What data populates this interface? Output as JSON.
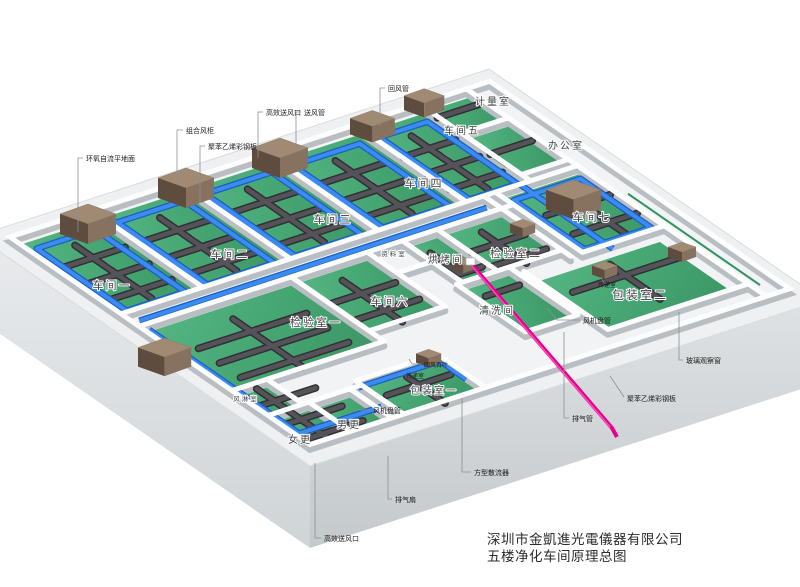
{
  "title_block": {
    "line1": "深圳市金凱進光電儀器有限公司",
    "line2": "五楼净化车间原理总图"
  },
  "colors": {
    "floor_green": "#46a673",
    "floor_green_dark": "#3c9765",
    "duct_blue": "#3b8bf2",
    "duct_blue_dark": "#1a5fc2",
    "duct_dark": "#474549",
    "ahu_brown_top": "#a18a74",
    "ahu_brown_front": "#5e4d3e",
    "exhaust_pink": "#e6008f",
    "slab_gray": "#d5d9db",
    "wall_white": "#fdfdfe",
    "stripe_green": "#2f9160"
  },
  "annotations": [
    {
      "kind": "room",
      "t": "车间一",
      "x": 112,
      "y": 289,
      "s": 11
    },
    {
      "kind": "room",
      "t": "车间二",
      "x": 230,
      "y": 258,
      "s": 11
    },
    {
      "kind": "room",
      "t": "车间三",
      "x": 333,
      "y": 223,
      "s": 11
    },
    {
      "kind": "room",
      "t": "车间四",
      "x": 424,
      "y": 187,
      "s": 11
    },
    {
      "kind": "room",
      "t": "车间五",
      "x": 462,
      "y": 134,
      "s": 10
    },
    {
      "kind": "room",
      "t": "计量室",
      "x": 493,
      "y": 105,
      "s": 10
    },
    {
      "kind": "room",
      "t": "办公室",
      "x": 566,
      "y": 149,
      "s": 10
    },
    {
      "kind": "room",
      "t": "车间七",
      "x": 592,
      "y": 221,
      "s": 11
    },
    {
      "kind": "room",
      "t": "车间六",
      "x": 390,
      "y": 305,
      "s": 11
    },
    {
      "kind": "room",
      "t": "检验室一",
      "x": 316,
      "y": 326,
      "s": 11
    },
    {
      "kind": "room",
      "t": "资料室",
      "x": 394,
      "y": 256,
      "s": 6.5
    },
    {
      "kind": "room",
      "t": "烘烤间",
      "x": 446,
      "y": 263,
      "s": 10
    },
    {
      "kind": "room",
      "t": "检验室二",
      "x": 516,
      "y": 257,
      "s": 11
    },
    {
      "kind": "room",
      "t": "清洗间",
      "x": 497,
      "y": 314,
      "s": 10
    },
    {
      "kind": "room",
      "t": "包装室二",
      "x": 640,
      "y": 299,
      "s": 12
    },
    {
      "kind": "room",
      "t": "包装室一",
      "x": 434,
      "y": 394,
      "s": 10
    },
    {
      "kind": "room",
      "t": "风淋室",
      "x": 246,
      "y": 401,
      "s": 6.5
    },
    {
      "kind": "room",
      "t": "女更",
      "x": 300,
      "y": 443,
      "s": 10
    },
    {
      "kind": "room",
      "t": "男更",
      "x": 349,
      "y": 428,
      "s": 10
    },
    {
      "kind": "callout",
      "t": "组合风柜",
      "x": 186,
      "y": 133,
      "s": 7,
      "leader": [
        183,
        130,
        177,
        130,
        177,
        176
      ]
    },
    {
      "kind": "callout",
      "t": "聚苯乙烯彩钢板",
      "x": 208,
      "y": 149,
      "s": 7,
      "leader": [
        205,
        146,
        200,
        146,
        200,
        203
      ]
    },
    {
      "kind": "callout",
      "t": "环氧自流平地面",
      "x": 86,
      "y": 161,
      "s": 7,
      "leader": [
        83,
        158,
        78,
        158,
        78,
        232
      ]
    },
    {
      "kind": "callout",
      "t": "高效送风口",
      "x": 266,
      "y": 115,
      "s": 7,
      "leader": [
        263,
        112,
        258,
        112,
        258,
        158
      ]
    },
    {
      "kind": "callout",
      "t": "送风管",
      "x": 304,
      "y": 115,
      "s": 7,
      "leader": [
        301,
        112,
        296,
        112,
        296,
        147
      ]
    },
    {
      "kind": "callout",
      "t": "回风管",
      "x": 388,
      "y": 91,
      "s": 7,
      "leader": [
        385,
        88,
        380,
        88,
        380,
        126
      ]
    },
    {
      "kind": "callout",
      "t": "回风百叶",
      "x": 424,
      "y": 367,
      "s": 6,
      "leader": [
        421,
        364,
        412,
        364,
        409,
        359
      ]
    },
    {
      "kind": "callout",
      "t": "传递室",
      "x": 406,
      "y": 378,
      "s": 6,
      "leader": [
        403,
        375,
        398,
        375
      ]
    },
    {
      "kind": "callout",
      "t": "传递室",
      "x": 598,
      "y": 287,
      "s": 6,
      "leader": [
        604,
        283,
        601,
        277
      ]
    },
    {
      "kind": "callout",
      "t": "风机盘管",
      "x": 583,
      "y": 323,
      "s": 7,
      "leader": [
        580,
        320,
        557,
        320,
        547,
        308
      ]
    },
    {
      "kind": "callout",
      "t": "风机盘管",
      "x": 373,
      "y": 413,
      "s": 7,
      "leader": [
        370,
        410,
        355,
        410
      ]
    },
    {
      "kind": "callout",
      "t": "玻璃观察窗",
      "x": 686,
      "y": 363,
      "s": 7,
      "leader": [
        683,
        360,
        679,
        360,
        679,
        312
      ]
    },
    {
      "kind": "callout",
      "t": "聚苯乙烯彩钢板",
      "x": 627,
      "y": 401,
      "s": 7,
      "leader": [
        624,
        397,
        610,
        376
      ]
    },
    {
      "kind": "callout",
      "t": "排气管",
      "x": 572,
      "y": 421,
      "s": 7,
      "leader": [
        569,
        418,
        564,
        418,
        564,
        332
      ]
    },
    {
      "kind": "callout",
      "t": "方型散流器",
      "x": 474,
      "y": 475,
      "s": 7,
      "leader": [
        471,
        472,
        462,
        472,
        462,
        398
      ]
    },
    {
      "kind": "callout",
      "t": "排气扇",
      "x": 395,
      "y": 502,
      "s": 7,
      "leader": [
        392,
        499,
        388,
        499,
        388,
        456
      ]
    },
    {
      "kind": "callout",
      "t": "高效送风口",
      "x": 324,
      "y": 541,
      "s": 7,
      "leader": [
        321,
        538,
        315,
        538,
        315,
        463
      ]
    }
  ]
}
